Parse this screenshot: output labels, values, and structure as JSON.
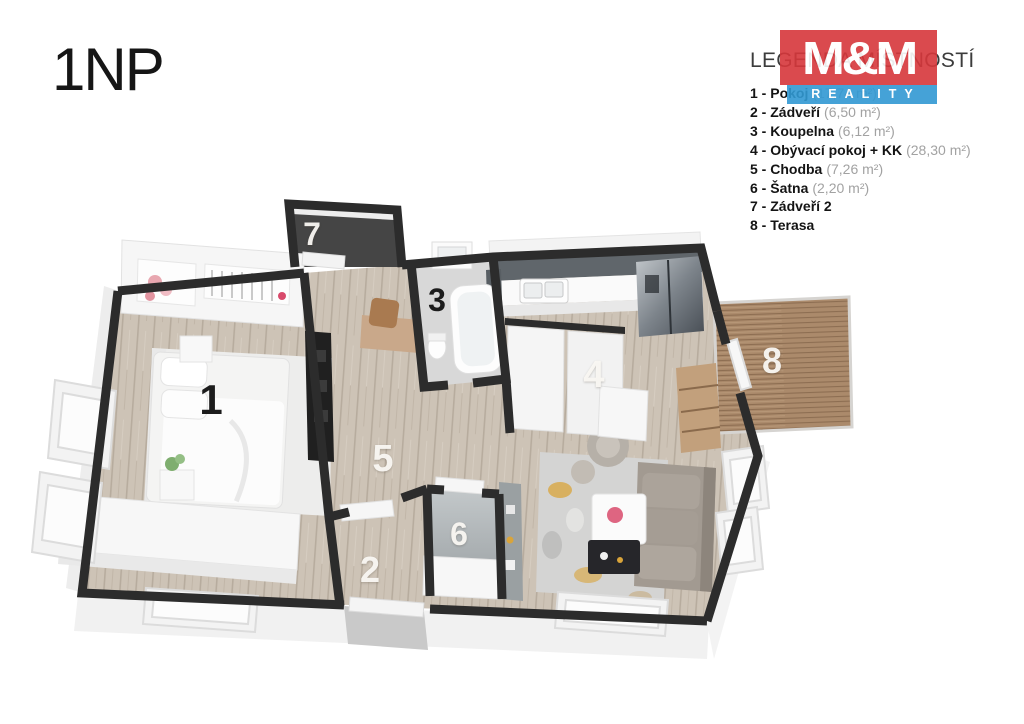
{
  "page_title": "1NP",
  "legend": {
    "title": "LEGENDA MÍSTNOSTÍ",
    "items": [
      {
        "bold": "1 - Pokoj",
        "area": "(17,74 m²)"
      },
      {
        "bold": "2 - Zádveří",
        "area": "(6,50 m²)"
      },
      {
        "bold": "3 - Koupelna",
        "area": "(6,12 m²)"
      },
      {
        "bold": "4 - Obývací pokoj + KK",
        "area": "(28,30 m²)"
      },
      {
        "bold": "5 - Chodba",
        "area": "(7,26 m²)"
      },
      {
        "bold": "6 - Šatna",
        "area": "(2,20 m²)"
      },
      {
        "bold": "7 - Zádveří 2",
        "area": ""
      },
      {
        "bold": "8 - Terasa",
        "area": ""
      }
    ]
  },
  "logo": {
    "top_text": "M&M",
    "bottom_text": "REALITY",
    "red": "#d7373b",
    "blue": "#3199d3"
  },
  "floorplan": {
    "room_labels": [
      {
        "num": "1",
        "room": "Pokoj"
      },
      {
        "num": "2",
        "room": "Zádveří"
      },
      {
        "num": "3",
        "room": "Koupelna"
      },
      {
        "num": "4",
        "room": "Obývací pokoj + KK"
      },
      {
        "num": "5",
        "room": "Chodba"
      },
      {
        "num": "6",
        "room": "Šatna"
      },
      {
        "num": "7",
        "room": "Zádveří 2"
      },
      {
        "num": "8",
        "room": "Terasa"
      }
    ],
    "palette": {
      "wall": "#2c2c2c",
      "wood_floor": "#cdc3b6",
      "terrace_deck": "#ab8a6b",
      "bath_floor": "#d8d8d8",
      "furniture_white": "#f6f6f6",
      "backsplash_gray": "#60666b",
      "sofa_gray": "#a29a91",
      "rug_accent_yellow": "#d9a43a"
    }
  }
}
